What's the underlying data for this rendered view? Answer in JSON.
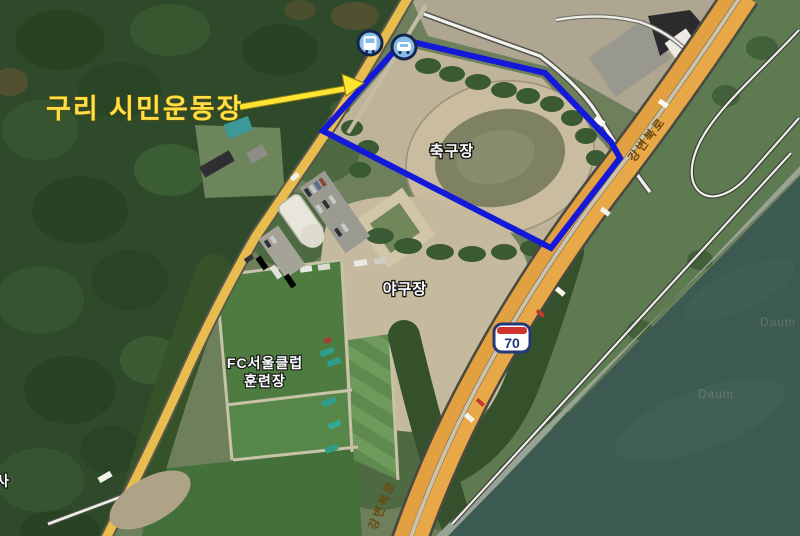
{
  "map_annotation": {
    "title": "구리 시민운동장"
  },
  "labels": {
    "soccer_field": "축구장",
    "baseball_field": "야구장",
    "training_ground_line1": "FC서울클럽",
    "training_ground_line2": "훈련장",
    "partial_place": "사"
  },
  "road_labels": [
    {
      "text": "강변북로"
    },
    {
      "text": "강변북로"
    }
  ],
  "route_shield": {
    "number": "70"
  },
  "markers": [
    {
      "name": "bus-stop"
    },
    {
      "name": "car"
    }
  ],
  "watermarks": [
    {
      "text": "Daum"
    },
    {
      "text": "Daum"
    }
  ],
  "colors": {
    "annotation_polygon": "#1418d8",
    "annotation_text_arrow": "#ffe433",
    "highway_orange": "#e2a041",
    "local_road_yellow": "#e9bd4d",
    "water": "#3d5a52",
    "forest": "#2f4a2b",
    "pitch_green": "#4e7c40",
    "dirt_tan": "#c0b499",
    "shield_border": "#223a78",
    "shield_band_red": "#cf3330",
    "marker_fill": "#88bce8",
    "marker_ring": "#14264e"
  }
}
